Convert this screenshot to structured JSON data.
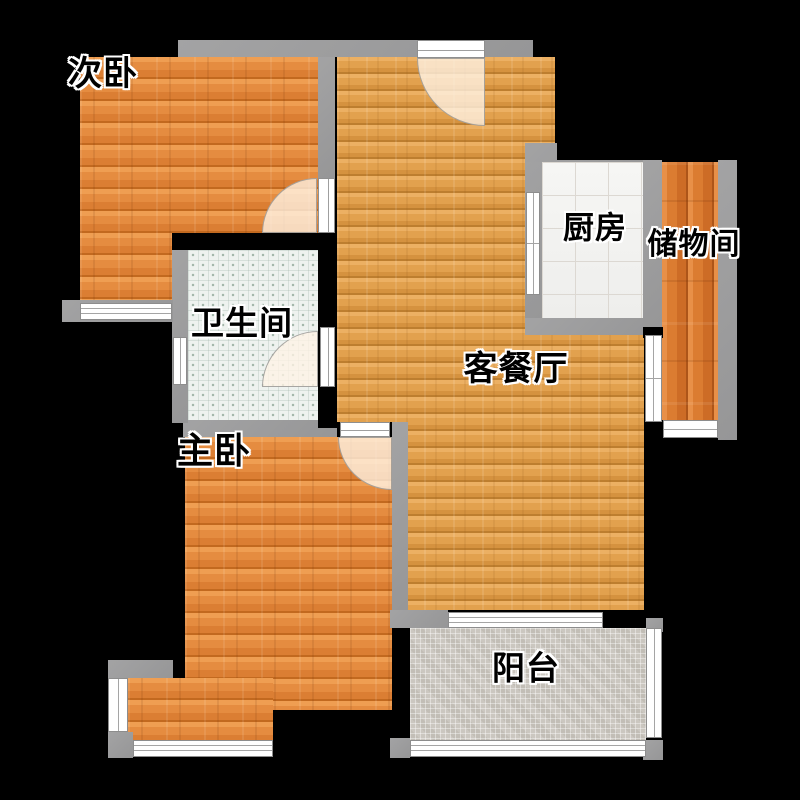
{
  "rooms": {
    "secondary_bedroom": {
      "label": "次卧"
    },
    "bathroom": {
      "label": "卫生间"
    },
    "kitchen": {
      "label": "厨房"
    },
    "storage": {
      "label": "储物间"
    },
    "living_dining": {
      "label": "客餐厅"
    },
    "master_bedroom": {
      "label": "主卧"
    },
    "balcony": {
      "label": "阳台"
    }
  },
  "colors": {
    "background": "#000000",
    "wall_gray": "#9a9a9b",
    "wall_black": "#000000",
    "window_white": "#ffffff",
    "wood_bedroom": "#e08a3e",
    "wood_living": "#e2a24f",
    "wood_storage": "#d97b30",
    "tile_kitchen": "#f3f3f1",
    "tile_bathroom": "#eef2ef",
    "tile_balcony": "#cbc7c0",
    "door_swing": "rgba(255,244,229,0.78)"
  }
}
